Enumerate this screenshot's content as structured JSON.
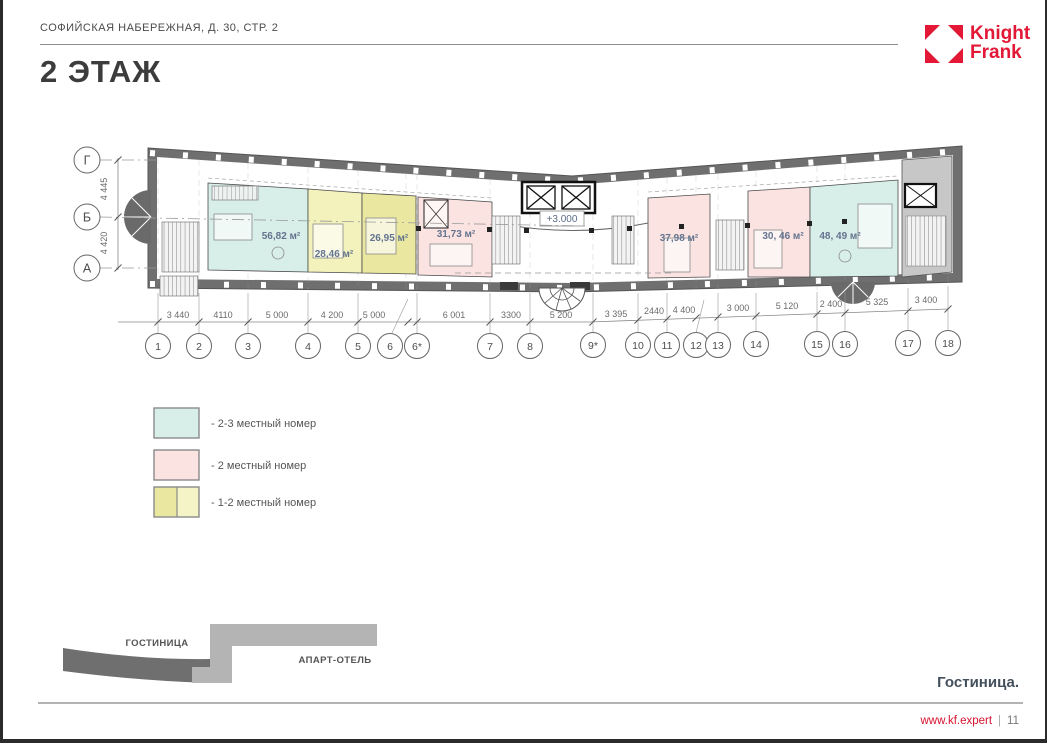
{
  "page": {
    "header": "СОФИЙСКАЯ НАБЕРЕЖНАЯ, Д. 30, СТР. 2",
    "title": "2 ЭТАЖ",
    "caption": "Гостиница.",
    "footer": {
      "site": "www.kf.expert",
      "separator": "|",
      "page_number": "11"
    }
  },
  "brand": {
    "line1": "Knight",
    "line2": "Frank"
  },
  "colors": {
    "brand_red": "#e21836",
    "wall": "#6f6f6f",
    "stair_gray": "#c7c7c7",
    "room_2_3": "#d8efe9",
    "room_2": "#fbe3e2",
    "room_1_2_light": "#f3f2bc",
    "room_1_2_dark": "#eae8a0",
    "hotel_dark": "#6f6f6f",
    "apart_light": "#b4b4b4"
  },
  "plan": {
    "level_mark": "+3.000",
    "rooms": [
      {
        "area": "56,82 м²",
        "type": "2-3 местный номер"
      },
      {
        "area": "28,46 м²",
        "type": "1-2 местный номер"
      },
      {
        "area": "26,95 м²",
        "type": "1-2 местный номер"
      },
      {
        "area": "31,73 м²",
        "type": "2 местный номер"
      },
      {
        "area": "37,98 м²",
        "type": "2 местный номер"
      },
      {
        "area": "30, 46 м²",
        "type": "2 местный номер"
      },
      {
        "area": "48, 49 м²",
        "type": "2-3 местный номер"
      }
    ],
    "row_axes": [
      "Г",
      "Б",
      "А"
    ],
    "row_dims": [
      "4 445",
      "4 420"
    ],
    "col_axes": [
      "1",
      "2",
      "3",
      "4",
      "5",
      "6",
      "6*",
      "7",
      "8",
      "9*",
      "10",
      "11",
      "12",
      "13",
      "14",
      "15",
      "16",
      "17",
      "18"
    ],
    "col_dims": [
      "3 440",
      "4110",
      "5 000",
      "4 200",
      "5 000",
      "6 001",
      "3300",
      "5 200",
      "3 395",
      "2440",
      "4 400",
      "3 000",
      "5 120",
      "2 400",
      "5 325",
      "3 400"
    ]
  },
  "legend": {
    "items": [
      {
        "label": "- 2-3 местный номер",
        "colors": [
          "#d8efe9"
        ]
      },
      {
        "label": "- 2 местный номер",
        "colors": [
          "#fbe3e2"
        ]
      },
      {
        "label": "- 1-2 местный номер",
        "colors": [
          "#eae8a0",
          "#f5f4c6"
        ]
      }
    ]
  },
  "site_map": {
    "hotel_label": "ГОСТИНИЦА",
    "apart_label": "АПАРТ-ОТЕЛЬ"
  }
}
